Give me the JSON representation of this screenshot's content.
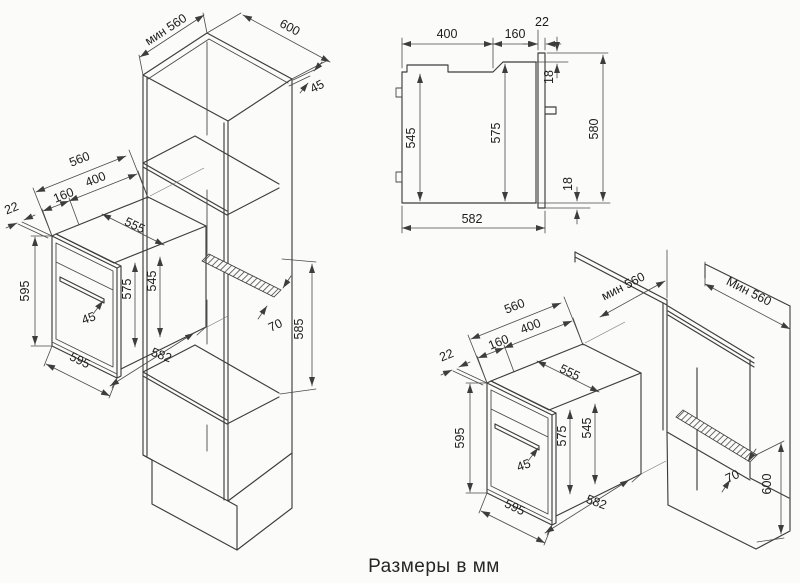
{
  "caption": "Размеры в мм",
  "colors": {
    "line": "#3d3d3d",
    "text": "#1d1d1d",
    "background": "#fbfbfa"
  },
  "views": {
    "column": {
      "description": "tall-column built-in installation, isometric",
      "dims": {
        "min_depth": "мин 560",
        "width_600": "600",
        "top_45": "45",
        "depth_560": "560",
        "d160": "160",
        "d400": "400",
        "d22": "22",
        "d555": "555",
        "height_595": "595",
        "d575": "575",
        "d545": "545",
        "d45": "45",
        "width_595": "595",
        "d582": "582",
        "vent_70": "70",
        "niche_585": "585"
      }
    },
    "profile": {
      "description": "side section of oven",
      "dims": {
        "d400": "400",
        "d160": "160",
        "d22": "22",
        "d18_top": "18",
        "d545": "545",
        "d575": "575",
        "d580": "580",
        "d18_bottom": "18",
        "d582": "582"
      }
    },
    "base": {
      "description": "under-counter corner installation, isometric",
      "dims": {
        "min_depth_niche": "мин 560",
        "min_depth_counter": "Мин 560",
        "depth_560": "560",
        "d160": "160",
        "d400": "400",
        "d22": "22",
        "d555": "555",
        "height_595": "595",
        "d575": "575",
        "d545": "545",
        "d45": "45",
        "width_595": "595",
        "d582": "582",
        "vent_70": "70",
        "niche_600": "600"
      }
    }
  }
}
